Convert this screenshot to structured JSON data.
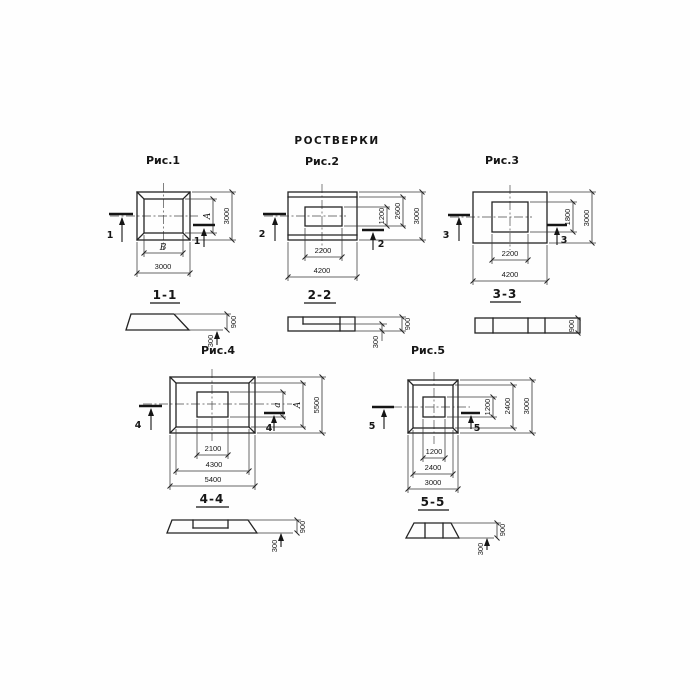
{
  "page": {
    "title": "РОСТВЕРКИ",
    "ink_color": "#232323",
    "paper_color": "#ffffff"
  },
  "figures": {
    "fig1": {
      "title": "Рис.1",
      "cut_mark": "1",
      "plan_dims": {
        "inner_width": "В",
        "outer_width": "3000",
        "inner_height": "А",
        "outer_height": "3000"
      },
      "section": {
        "label": "1-1",
        "step_height": "300",
        "total_height": "900"
      }
    },
    "fig2": {
      "title": "Рис.2",
      "cut_mark": "2",
      "plan_dims": {
        "inner_width": "2200",
        "outer_width": "4200",
        "inner_height": "1200",
        "mid_height": "2600",
        "outer_height": "3000"
      },
      "section": {
        "label": "2-2",
        "step_height": "300",
        "total_height": "900"
      }
    },
    "fig3": {
      "title": "Рис.3",
      "cut_mark": "3",
      "plan_dims": {
        "inner_width": "2200",
        "outer_width": "4200",
        "inner_height": "1800",
        "outer_height": "3000"
      },
      "section": {
        "label": "3-3",
        "total_height": "900"
      }
    },
    "fig4": {
      "title": "Рис.4",
      "cut_mark": "4",
      "plan_dims": {
        "inner_width": "2100",
        "mid_width": "4300",
        "outer_width": "5400",
        "inner_height": "а",
        "mid_height": "А",
        "outer_height": "5500"
      },
      "section": {
        "label": "4-4",
        "step_height": "300",
        "total_height": "900"
      }
    },
    "fig5": {
      "title": "Рис.5",
      "cut_mark": "5",
      "plan_dims": {
        "inner_width": "1200",
        "mid_width": "2400",
        "outer_width": "3000",
        "inner_height": "1200",
        "mid_height": "2400",
        "outer_height": "3000"
      },
      "section": {
        "label": "5-5",
        "step_height": "300",
        "total_height": "900"
      }
    }
  }
}
